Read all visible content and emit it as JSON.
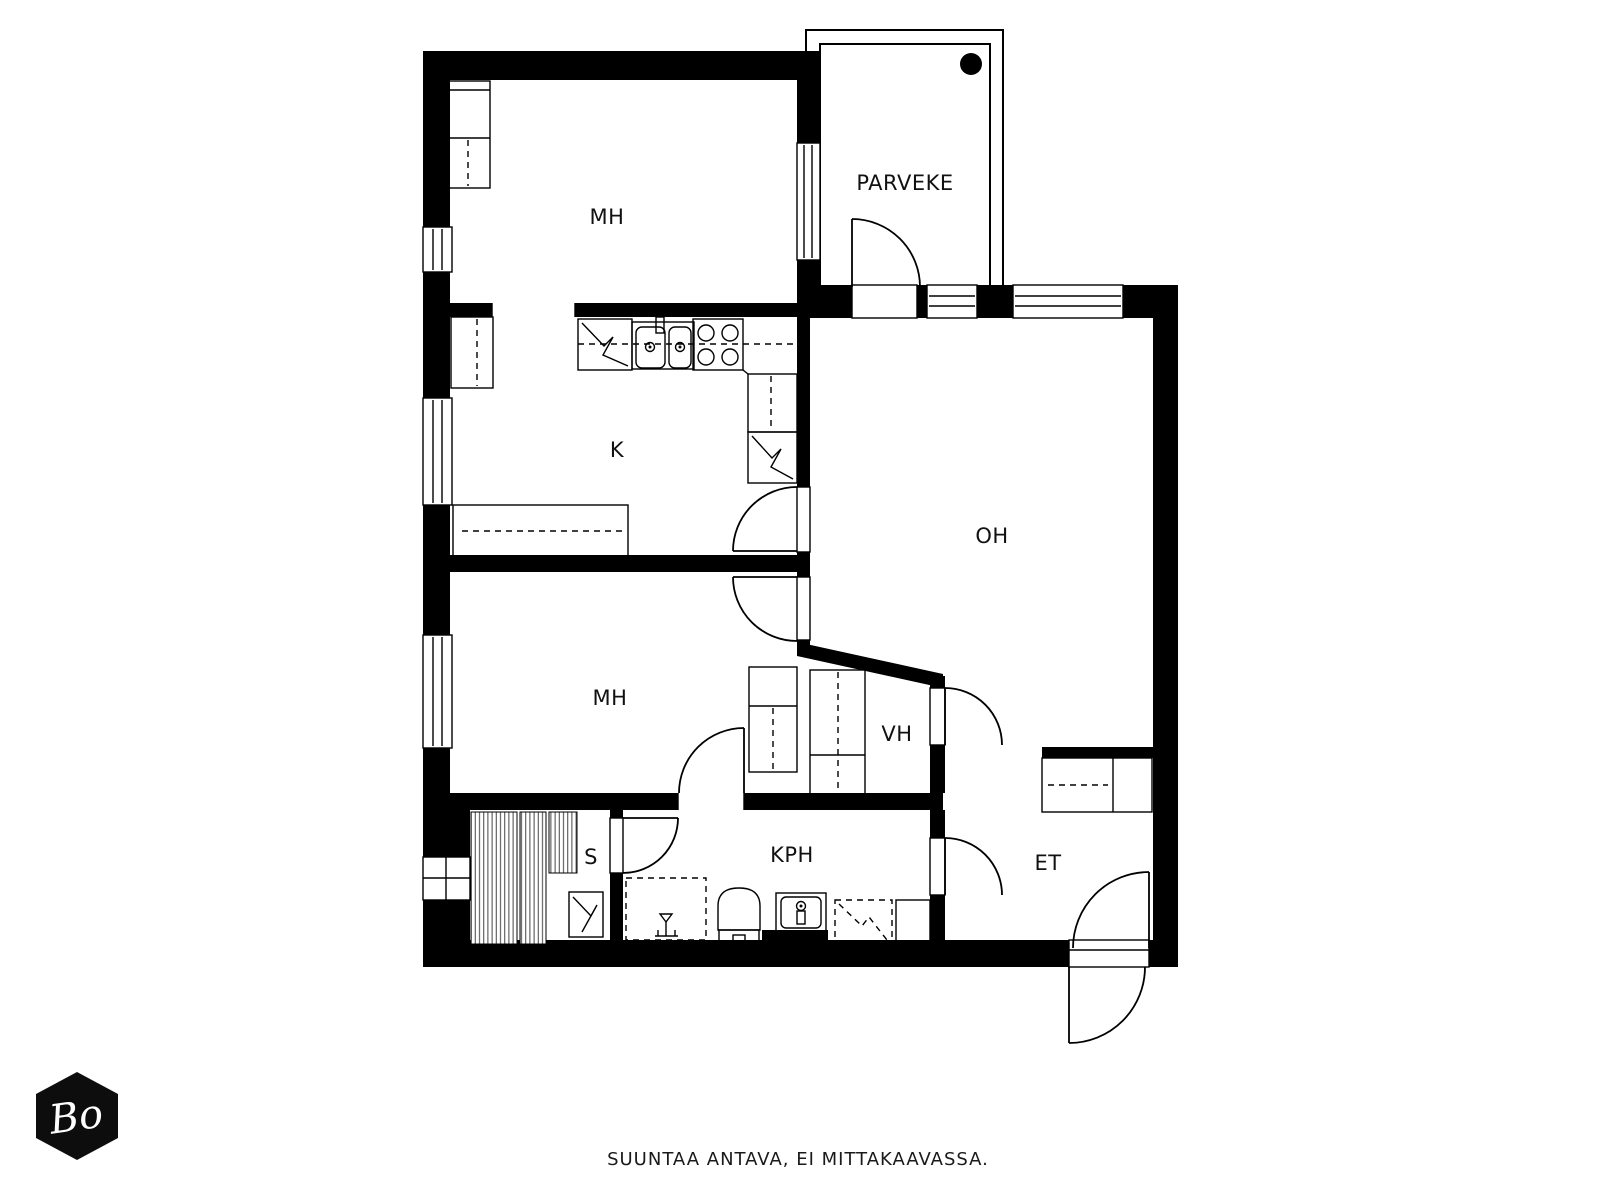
{
  "rooms": [
    {
      "id": "bedroom-1",
      "label": "MH"
    },
    {
      "id": "balcony",
      "label": "PARVEKE"
    },
    {
      "id": "kitchen",
      "label": "K"
    },
    {
      "id": "living-room",
      "label": "OH"
    },
    {
      "id": "bedroom-2",
      "label": "MH"
    },
    {
      "id": "walk-in-closet",
      "label": "VH"
    },
    {
      "id": "sauna",
      "label": "S"
    },
    {
      "id": "bathroom",
      "label": "KPH"
    },
    {
      "id": "entry",
      "label": "ET"
    }
  ],
  "footer": {
    "disclaimer": "SUUNTAA ANTAVA, EI MITTAKAAVASSA."
  },
  "logo": {
    "text": "Bo"
  },
  "colors": {
    "wall": "#000000",
    "background": "#ffffff"
  },
  "fixtures": [
    "fridge",
    "kitchen-sink",
    "stove",
    "tall-cabinet",
    "freezer",
    "kitchen-counter",
    "wardrobe",
    "sauna-benches",
    "sauna-heater",
    "shower-area",
    "shower-tap",
    "toilet",
    "hand-sink",
    "washing-machine-reservation",
    "entry-cabinet",
    "balcony-floor-drain"
  ]
}
